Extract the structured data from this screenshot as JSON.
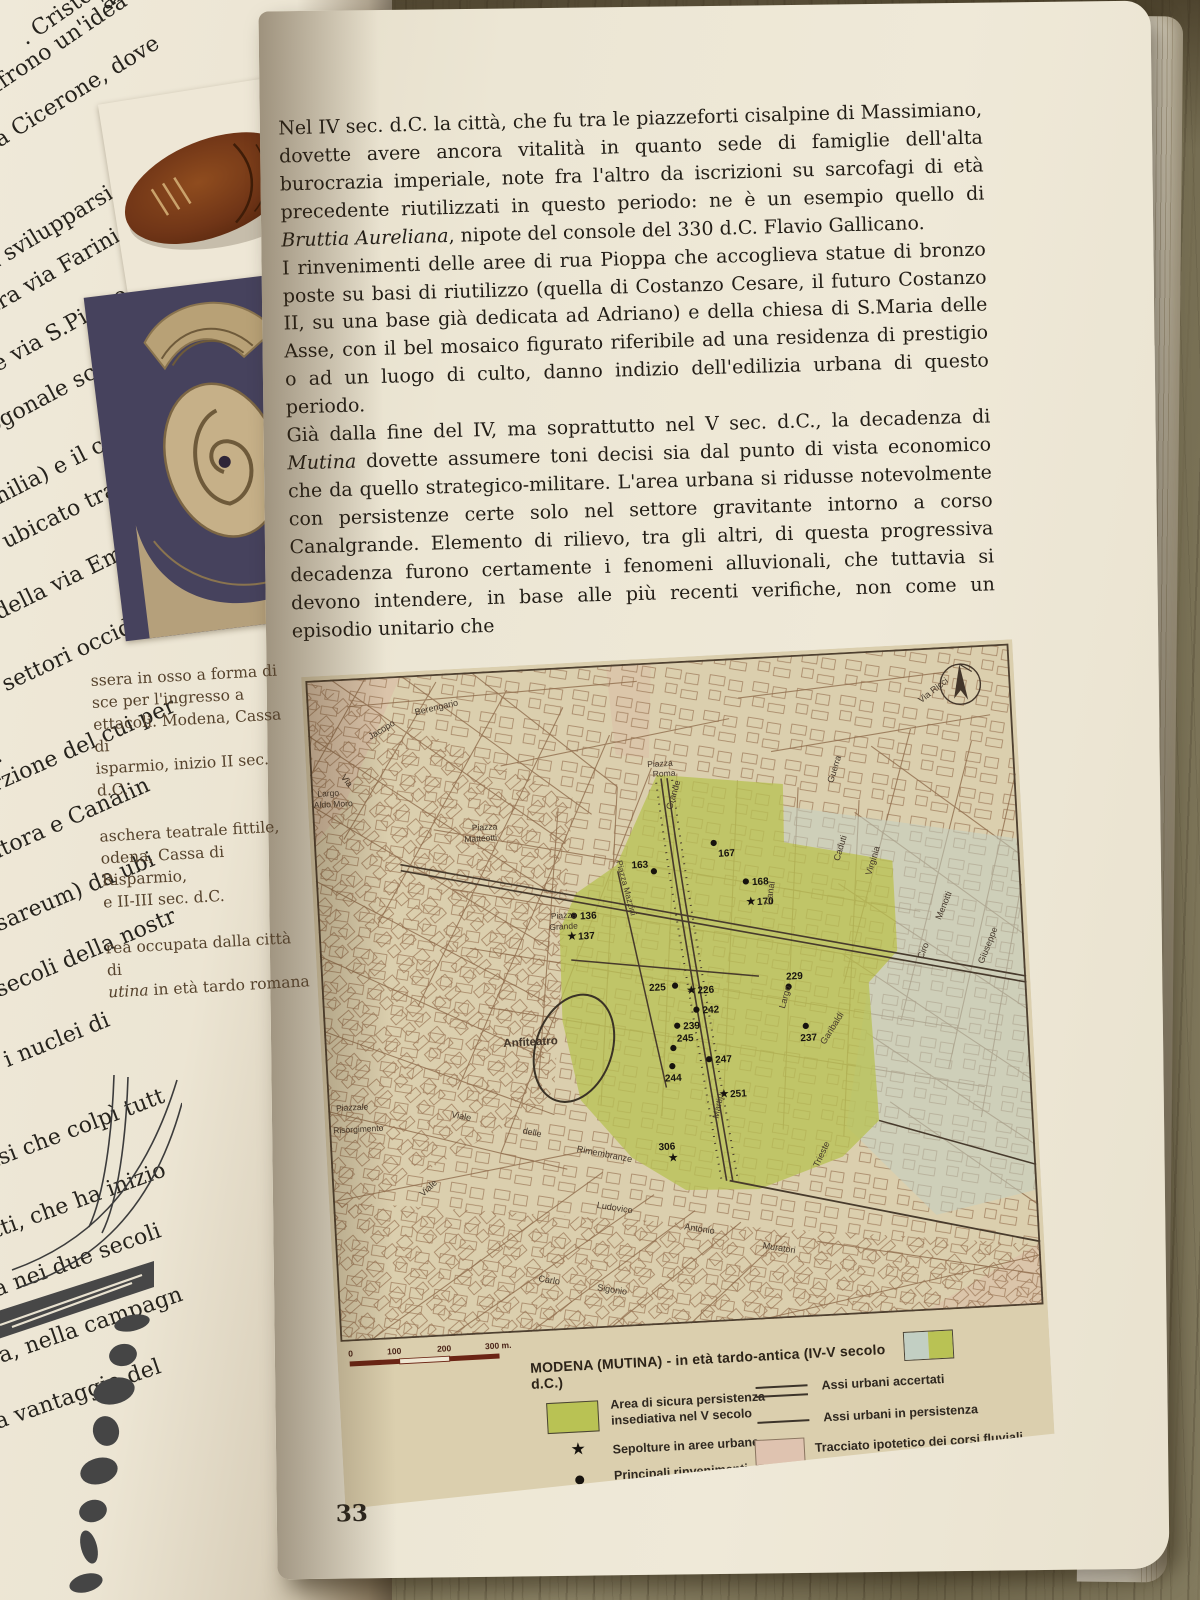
{
  "book": {
    "page_number": "33",
    "main_text": {
      "p1_a": "Nel IV sec. d.C. la città, che fu tra le piazzeforti cisalpine di Massimiano, dovette avere ancora vitalità in quanto sede di famiglie dell'alta burocrazia imperiale, note fra l'altro da iscrizioni su sarcofagi di età precedente riutilizzati in questo periodo: ne è un esempio quello di ",
      "p1_italic": "Bruttia Aureliana",
      "p1_b": ", nipote del console del 330 d.C. Flavio Gallicano.",
      "p2": "I rinvenimenti delle aree di rua Pioppa che accoglieva statue di bronzo poste su basi di riutilizzo (quella di Costanzo Cesare, il futuro Costanzo II, su una base già dedicata ad Adriano) e della chiesa di S.Maria delle Asse, con il bel mosaico figurato riferibile ad una residenza di prestigio o ad un luogo di culto, danno indizio dell'edilizia urbana di questo periodo.",
      "p3_a": "Già dalla fine del IV, ma soprattutto nel V sec. d.C., la decadenza di ",
      "p3_italic": "Mutina",
      "p3_b": " dovette assumere toni decisi sia dal punto di vista economico che da quello strategico-militare. L'area urbana si ridusse notevolmente con persistenze certe solo nel settore gravitante intorno a corso Canalgrande. Elemento di rilievo, tra gli altri, di questa progressiva decadenza furono certamente i fenomeni alluvionali, che tuttavia si devono intendere, in base alle più recenti verifiche, non come un episodio unitario che"
    },
    "captions": {
      "c1": [
        "ssera in osso a forma di",
        "sce per l'ingresso a",
        "ettacoli. Modena, Cassa di",
        "isparmio, inizio II sec. d.C."
      ],
      "c2": [
        "aschera teatrale fittile,",
        "odena, Cassa di Risparmio,",
        "e II-III sec. d.C."
      ],
      "c3_line1": "rea occupata dalla città di",
      "c3_italic": "utina",
      "c3_rest": " in età tardo romana"
    },
    "left_page_fragments": [
      {
        "t": "aree del Pala",
        "x": 95,
        "y": -5,
        "r": -36
      },
      {
        "t": ". Cristoforo, di via",
        "x": 15,
        "y": 30,
        "r": -35
      },
      {
        "t": "offrono un'idea dell",
        "x": -25,
        "y": 85,
        "r": -34
      },
      {
        "t": "a da Cicerone, dove",
        "x": -40,
        "y": 150,
        "r": -32
      },
      {
        "t": "C.",
        "x": -42,
        "y": 222,
        "r": -31
      },
      {
        "t": "va svilupparsi per",
        "x": -30,
        "y": 262,
        "r": -31
      },
      {
        "t": "esa tra via Farini e vial",
        "x": -55,
        "y": 320,
        "r": -30
      },
      {
        "t": "oma e via S.Pietro in",
        "x": -60,
        "y": 382,
        "r": -29
      },
      {
        "t": "o ortogonale scandit",
        "x": -65,
        "y": 442,
        "r": -28
      },
      {
        "t": "Emilia) e il cardo ma",
        "x": -30,
        "y": 498,
        "r": -27
      },
      {
        "t": "e era ubicato tra rua",
        "x": -60,
        "y": 560,
        "r": -26
      },
      {
        "t": "essi della via Emilia",
        "x": -55,
        "y": 625,
        "r": -26
      },
      {
        "t": "nei settori occidental",
        "x": -40,
        "y": 692,
        "r": -25
      },
      {
        "t": "d.C.",
        "x": -45,
        "y": 762,
        "r": -25
      },
      {
        "t": "na porzione del cui per",
        "x": -70,
        "y": 800,
        "r": -24
      },
      {
        "t": "Mondatora e Canalin",
        "x": -75,
        "y": 870,
        "r": -24
      },
      {
        "t": "i (Caesareum) da ubi",
        "x": -70,
        "y": 940,
        "r": -23
      },
      {
        "t": "ni due secoli della nostr",
        "x": -80,
        "y": 1010,
        "r": -23
      },
      {
        "t": "rivata: i nuclei di",
        "x": -75,
        "y": 1080,
        "r": -22
      },
      {
        "t": "la crisi che colpì tutt",
        "x": -60,
        "y": 1168,
        "r": -21
      },
      {
        "t": "infatti, che ha inizio",
        "x": -52,
        "y": 1235,
        "r": -20
      },
      {
        "t": "ntuerà nei due secoli",
        "x": -68,
        "y": 1300,
        "r": -20
      },
      {
        "t": "mparsa, nella campagn",
        "x": -72,
        "y": 1368,
        "r": -19
      },
      {
        "t": "nsiva, a vantaggio del",
        "x": -78,
        "y": 1435,
        "r": -19
      }
    ]
  },
  "map": {
    "title": "MODENA (MUTINA) - in età tardo-antica (IV-V secolo d.C.)",
    "scale_labels": [
      "0",
      "100",
      "200",
      "300 m."
    ],
    "legend": [
      {
        "symbol": "area-green",
        "label": "Area di sicura persistenza insediativa nel V secolo"
      },
      {
        "symbol": "star",
        "label": "Sepolture in aree urbane"
      },
      {
        "symbol": "dot",
        "label": "Principali rinvenimenti"
      },
      {
        "symbol": "double-line",
        "label": "Assi urbani accertati"
      },
      {
        "symbol": "single-line",
        "label": "Assi urbani in persistenza"
      },
      {
        "symbol": "area-pink",
        "label": "Tracciato ipotetico dei corsi fluviali"
      }
    ],
    "colors": {
      "area_green": "#b9c254",
      "area_pink": "#dfc3b0",
      "water_gray": "#c2cfc3",
      "axes": "#473a2c",
      "scale_bar": "#6b2414",
      "map_paper": "#dbcfae"
    },
    "points": [
      {
        "n": "136",
        "type": "dot",
        "x": 255,
        "y": 248
      },
      {
        "n": "137",
        "type": "star",
        "x": 252,
        "y": 268
      },
      {
        "n": "163",
        "type": "dot",
        "x": 337,
        "y": 208,
        "dx": -22,
        "dy": -4
      },
      {
        "n": "167",
        "type": "dot",
        "x": 398,
        "y": 183,
        "dx": 4,
        "dy": 14
      },
      {
        "n": "168",
        "type": "dot",
        "x": 428,
        "y": 223
      },
      {
        "n": "170",
        "type": "star",
        "x": 432,
        "y": 243
      },
      {
        "n": "225",
        "type": "dot",
        "x": 352,
        "y": 323,
        "dx": -26,
        "dy": 4
      },
      {
        "n": "226",
        "type": "star",
        "x": 368,
        "y": 328
      },
      {
        "n": "242",
        "type": "dot",
        "x": 372,
        "y": 348
      },
      {
        "n": "239",
        "type": "dot",
        "x": 352,
        "y": 363
      },
      {
        "n": "245",
        "type": "dot",
        "x": 347,
        "y": 385,
        "dx": 4,
        "dy": -6
      },
      {
        "n": "244",
        "type": "dot",
        "x": 345,
        "y": 403,
        "dx": -8,
        "dy": 15
      },
      {
        "n": "247",
        "type": "dot",
        "x": 382,
        "y": 398
      },
      {
        "n": "251",
        "type": "star",
        "x": 395,
        "y": 433
      },
      {
        "n": "229",
        "type": "dot",
        "x": 465,
        "y": 330,
        "dx": -2,
        "dy": -7
      },
      {
        "n": "237",
        "type": "dot",
        "x": 480,
        "y": 370,
        "dx": -6,
        "dy": 15
      },
      {
        "n": "306",
        "type": "star",
        "x": 341,
        "y": 494,
        "dx": -14,
        "dy": -8
      }
    ],
    "labels": [
      {
        "t": "Berengario",
        "x": 108,
        "y": 40,
        "r": -10
      },
      {
        "t": "Jacopo",
        "x": 62,
        "y": 62,
        "r": -28
      },
      {
        "t": "Via",
        "x": 30,
        "y": 98,
        "r": 55
      },
      {
        "t": "Largo",
        "x": 6,
        "y": 116,
        "s": 8.5
      },
      {
        "t": "Aldo Moro",
        "x": 2,
        "y": 127,
        "s": 8.5
      },
      {
        "t": "Piazza",
        "x": 336,
        "y": 104,
        "s": 8.5
      },
      {
        "t": "Roma",
        "x": 341,
        "y": 114,
        "s": 8.5
      },
      {
        "t": "Piazza",
        "x": 158,
        "y": 158,
        "s": 8.5
      },
      {
        "t": "Matteotti",
        "x": 150,
        "y": 169,
        "s": 8.5
      },
      {
        "t": "Piazza Mazzini",
        "x": 300,
        "y": 196,
        "r": 78,
        "s": 8.5
      },
      {
        "t": "Piazza",
        "x": 232,
        "y": 250,
        "s": 8.5
      },
      {
        "t": "Grande",
        "x": 230,
        "y": 261,
        "s": 8.5
      },
      {
        "t": "Anfiteatro",
        "x": 178,
        "y": 375,
        "s": 11.5,
        "b": 1
      },
      {
        "t": "Piazzale",
        "x": 8,
        "y": 430,
        "s": 8.5
      },
      {
        "t": "Risorgimento",
        "x": 4,
        "y": 452,
        "s": 8.5
      },
      {
        "t": "Viale",
        "x": 122,
        "y": 442,
        "r": 14
      },
      {
        "t": "delle",
        "x": 192,
        "y": 462,
        "r": 14
      },
      {
        "t": "Rimembranze",
        "x": 245,
        "y": 483,
        "r": 14
      },
      {
        "t": "Ludovico",
        "x": 262,
        "y": 540,
        "r": 12
      },
      {
        "t": "Antonio",
        "x": 348,
        "y": 566,
        "r": 12
      },
      {
        "t": "Muratori",
        "x": 425,
        "y": 589,
        "r": 12
      },
      {
        "t": "Carlo",
        "x": 200,
        "y": 610,
        "r": 12
      },
      {
        "t": "Sigonio",
        "x": 258,
        "y": 622,
        "r": 12
      },
      {
        "t": "Martiri",
        "x": 388,
        "y": 458,
        "r": -75
      },
      {
        "t": "Trieste",
        "x": 485,
        "y": 512,
        "r": -62
      },
      {
        "t": "Menotti",
        "x": 620,
        "y": 272,
        "r": -65
      },
      {
        "t": "Ciro",
        "x": 600,
        "y": 310,
        "r": -65
      },
      {
        "t": "Giuseppe",
        "x": 660,
        "y": 318,
        "r": -65
      },
      {
        "t": "Largo",
        "x": 460,
        "y": 352,
        "r": -72
      },
      {
        "t": "Garibaldi",
        "x": 498,
        "y": 390,
        "r": -55
      },
      {
        "t": "Caduti",
        "x": 522,
        "y": 208,
        "r": -70
      },
      {
        "t": "Virginia",
        "x": 553,
        "y": 224,
        "r": -70
      },
      {
        "t": "Guerra",
        "x": 520,
        "y": 130,
        "r": -70
      },
      {
        "t": "Via Ricci",
        "x": 612,
        "y": 55,
        "r": -35
      },
      {
        "t": "Canal",
        "x": 452,
        "y": 248,
        "r": -78
      },
      {
        "t": "Grande",
        "x": 358,
        "y": 148,
        "r": -70
      },
      {
        "t": "Viale",
        "x": 90,
        "y": 520,
        "r": -40
      }
    ]
  }
}
